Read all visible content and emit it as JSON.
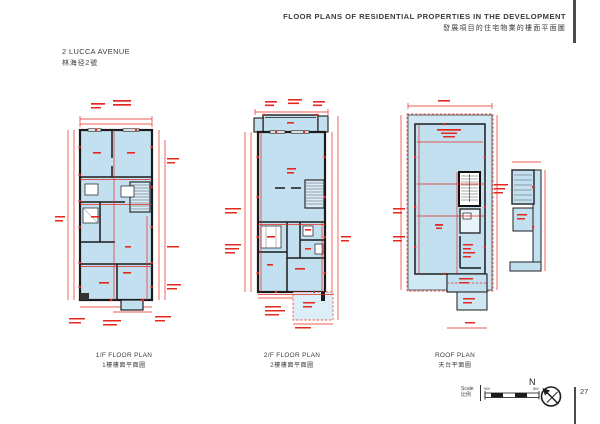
{
  "header": {
    "title_en": "FLOOR PLANS OF RESIDENTIAL PROPERTIES IN THE DEVELOPMENT",
    "title_zh": "發展項目的住宅物業的樓面平面圖"
  },
  "property": {
    "name_en": "2 LUCCA AVENUE",
    "name_zh": "林海径2號"
  },
  "plans": [
    {
      "caption_en": "1/F FLOOR PLAN",
      "caption_zh": "1樓樓面平面圖"
    },
    {
      "caption_en": "2/F FLOOR PLAN",
      "caption_zh": "2樓樓面平面圖"
    },
    {
      "caption_en": "ROOF PLAN",
      "caption_zh": "天台平面圖"
    }
  ],
  "footer": {
    "scale_label_en": "Scale",
    "scale_label_zh": "比例",
    "scale_min": "0M",
    "scale_max": "5M",
    "compass_letter": "N",
    "page_number": "27"
  },
  "colors": {
    "plan_fill": "#c3e0f0",
    "plan_fill_light": "#cfe8f4",
    "dimension_red": "#e5281e",
    "wall_black": "#1b1b1b",
    "rule_gray": "#4d4d4d",
    "text_dark": "#3b3b3b"
  }
}
